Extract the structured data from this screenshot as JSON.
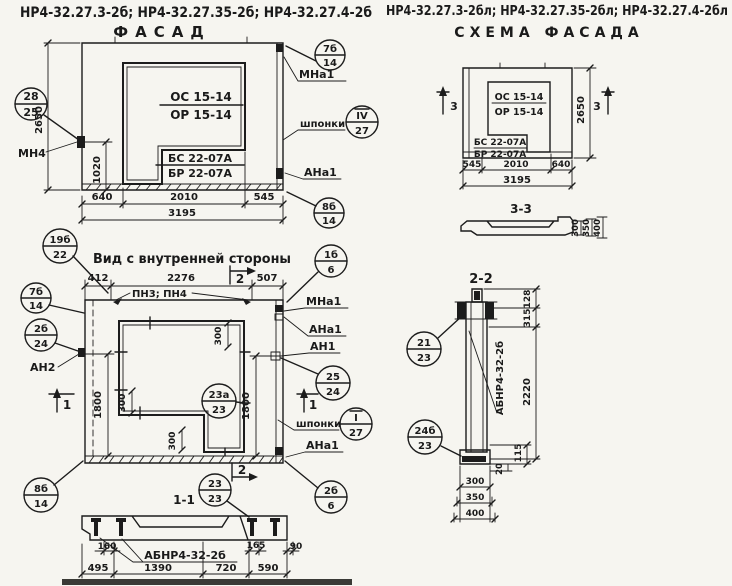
{
  "titles": {
    "left_codes": "НР4-32.27.3-2б; НР4-32.27.35-2б; НР4-32.27.4-2б",
    "left_view": "ФАСАД",
    "right_codes": "НР4-32.27.3-2бл; НР4-32.27.35-2бл; НР4-32.27.4-2бл",
    "right_view": "СХЕМА ФАСАДА"
  },
  "facade": {
    "window_block": {
      "top": "ОС 15-14",
      "bottom": "ОР 15-14"
    },
    "door_block": {
      "top": "БС 22-07А",
      "bottom": "БР 22-07А"
    },
    "dims": {
      "height": "2650",
      "sill": "1020",
      "b1": "640",
      "b2": "2010",
      "b3": "545",
      "total": "3195"
    },
    "labels": {
      "mn4": "МН4",
      "mna1": "МНа1",
      "shponki": "шпонки",
      "ana1": "АНа1"
    },
    "callouts": {
      "left": {
        "t": "28",
        "b": "25"
      },
      "top_right": {
        "t": "7б",
        "b": "14"
      },
      "keys": {
        "t": "IV",
        "b": "27"
      },
      "bottom_right": {
        "t": "8б",
        "b": "14"
      }
    }
  },
  "inner": {
    "title": "Вид с внутренней стороны",
    "dims": {
      "t1": "412",
      "t2": "2276",
      "t3": "507",
      "left_h": "1800",
      "right_h": "1800",
      "s1": "300",
      "s2": "300",
      "s3": "300"
    },
    "labels": {
      "pn": "ПН3; ПН4",
      "mna1": "МНа1",
      "ana1_top": "АНа1",
      "an1": "АН1",
      "shponki": "шпонки",
      "ana1_bottom": "АНа1",
      "an2": "АН2"
    },
    "markers": {
      "m1_left": "1",
      "m1_right": "1",
      "m2_top": "2",
      "m2_bottom": "2"
    },
    "callouts": {
      "top_left": {
        "t": "19б",
        "b": "22"
      },
      "left_upper": {
        "t": "7б",
        "b": "14"
      },
      "left_mid": {
        "t": "2б",
        "b": "24"
      },
      "bottom_left": {
        "t": "8б",
        "b": "14"
      },
      "top_right": {
        "t": "1б",
        "b": "6"
      },
      "right_mid": {
        "t": "25",
        "b": "24"
      },
      "keys": {
        "t": "I",
        "b": "27"
      },
      "window": {
        "t": "23а",
        "b": "23"
      },
      "bottom": {
        "t": "23",
        "b": "23"
      },
      "bottom_right": {
        "t": "2б",
        "b": "6"
      }
    }
  },
  "scheme": {
    "window_block": {
      "top": "ОС 15-14",
      "bottom": "ОР 15-14"
    },
    "door_block": {
      "top": "БС 22-07А",
      "bottom": "БР 22-07А"
    },
    "dims": {
      "height": "2650",
      "b1": "545",
      "b2": "2010",
      "b3": "640",
      "total": "3195"
    },
    "marker_left": "3",
    "marker_right": "3",
    "section": {
      "title": "3-3",
      "d1": "300",
      "d2": "350",
      "d3": "400"
    }
  },
  "section11": {
    "title": "1-1",
    "mark": "АБНР4-32-2б",
    "dims": {
      "a1": "160",
      "a2": "165",
      "a3": "90",
      "b1": "495",
      "b2": "1390",
      "b3": "720",
      "b4": "590"
    }
  },
  "section22": {
    "title": "2-2",
    "mark": "АБНР4-32-2б",
    "dims": {
      "d128": "128",
      "d315": "315",
      "d2220": "2220",
      "d115": "115",
      "d20": "20",
      "w1": "300",
      "w2": "350",
      "w3": "400"
    },
    "callouts": {
      "top": {
        "t": "21",
        "b": "23"
      },
      "bottom": {
        "t": "24б",
        "b": "23"
      }
    }
  }
}
